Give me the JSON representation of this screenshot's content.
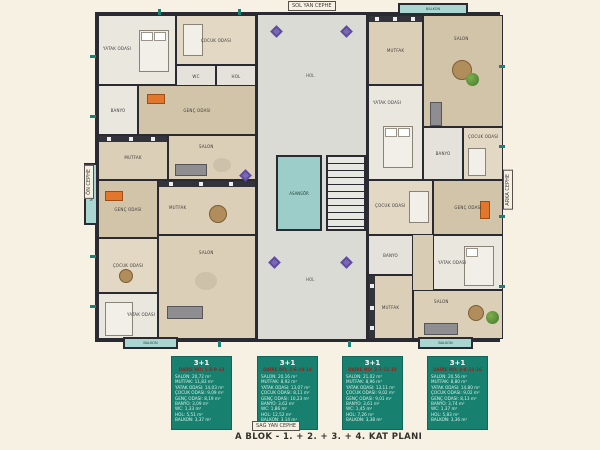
{
  "page": {
    "caption": "A BLOK - 1. + 2. + 3. + 4. KAT  PLANI"
  },
  "facade": {
    "top": "SOL YAN CEPHE",
    "bottom": "SAĞ YAN CEPHE",
    "left": "ÖN CEPHE",
    "right": "ARKA CEPHE"
  },
  "plan": {
    "labels": {
      "salon": "SALON",
      "mutfak": "MUTFAK",
      "yatak": "YATAK ODASI",
      "cocuk": "ÇOCUK ODASI",
      "genc": "GENÇ ODASI",
      "banyo": "BANYO",
      "wc": "WC",
      "hol": "HOL",
      "balkon": "BALKON",
      "asansor": "ASANSÖR"
    }
  },
  "units": [
    {
      "type": "3+1",
      "daire_no": "DAİRE NO: 1-5-9-13",
      "rooms": [
        {
          "label": "SALON",
          "area": "20,72 m²"
        },
        {
          "label": "MUTFAK",
          "area": "11,83 m²"
        },
        {
          "label": "YATAK ODASI",
          "area": "14,03 m²"
        },
        {
          "label": "ÇOCUK ODASI",
          "area": "9,09 m²"
        },
        {
          "label": "GENÇ ODASI",
          "area": "8,19 m²"
        },
        {
          "label": "BANYO",
          "area": "3,09 m²"
        },
        {
          "label": "WC",
          "area": "1,33 m²"
        },
        {
          "label": "HOL",
          "area": "5,51 m²"
        },
        {
          "label": "BALKON",
          "area": "3,37 m²"
        }
      ]
    },
    {
      "type": "3+1",
      "daire_no": "DAİRE NO: 2-6-10-14",
      "rooms": [
        {
          "label": "SALON",
          "area": "20,16 m²"
        },
        {
          "label": "MUTFAK",
          "area": "8,92 m²"
        },
        {
          "label": "YATAK ODASI",
          "area": "13,07 m²"
        },
        {
          "label": "ÇOCUK ODASI",
          "area": "8,11 m²"
        },
        {
          "label": "GENÇ ODASI",
          "area": "10,23 m²"
        },
        {
          "label": "BANYO",
          "area": "3,62 m²"
        },
        {
          "label": "WC",
          "area": "1,86 m²"
        },
        {
          "label": "HOL",
          "area": "12,52 m²"
        },
        {
          "label": "BALKON",
          "area": "3,14 m²"
        }
      ]
    },
    {
      "type": "3+1",
      "daire_no": "DAİRE NO: 3-7-11-15",
      "rooms": [
        {
          "label": "SALON",
          "area": "21,02 m²"
        },
        {
          "label": "MUTFAK",
          "area": "8,96 m²"
        },
        {
          "label": "YATAK ODASI",
          "area": "13,11 m²"
        },
        {
          "label": "ÇOCUK ODASI",
          "area": "9,02 m²"
        },
        {
          "label": "GENÇ ODASI",
          "area": "9,01 m²"
        },
        {
          "label": "BANYO",
          "area": "3,61 m²"
        },
        {
          "label": "WC",
          "area": "1,45 m²"
        },
        {
          "label": "HOL",
          "area": "7,26 m²"
        },
        {
          "label": "BALKON",
          "area": "3,38 m²"
        }
      ]
    },
    {
      "type": "3+1",
      "daire_no": "DAİRE NO: 4-8-12-16",
      "rooms": [
        {
          "label": "SALON",
          "area": "20,56 m²"
        },
        {
          "label": "MUTFAK",
          "area": "8,80 m²"
        },
        {
          "label": "YATAK ODASI",
          "area": "14,80 m²"
        },
        {
          "label": "ÇOCUK ODASI",
          "area": "9,02 m²"
        },
        {
          "label": "GENÇ ODASI",
          "area": "8,13 m²"
        },
        {
          "label": "BANYO",
          "area": "3,74 m²"
        },
        {
          "label": "WC",
          "area": "1,37 m²"
        },
        {
          "label": "HOL",
          "area": "5,83 m²"
        },
        {
          "label": "BALKON",
          "area": "3,36 m²"
        }
      ]
    }
  ],
  "colors": {
    "background": "#f6f1e2",
    "wall": "#2a2a33",
    "legend_teal": "#17806f",
    "daire_red": "#8e2620",
    "balcony_teal": "#a9d6d0",
    "tile_purple": "#5f4b9e"
  }
}
